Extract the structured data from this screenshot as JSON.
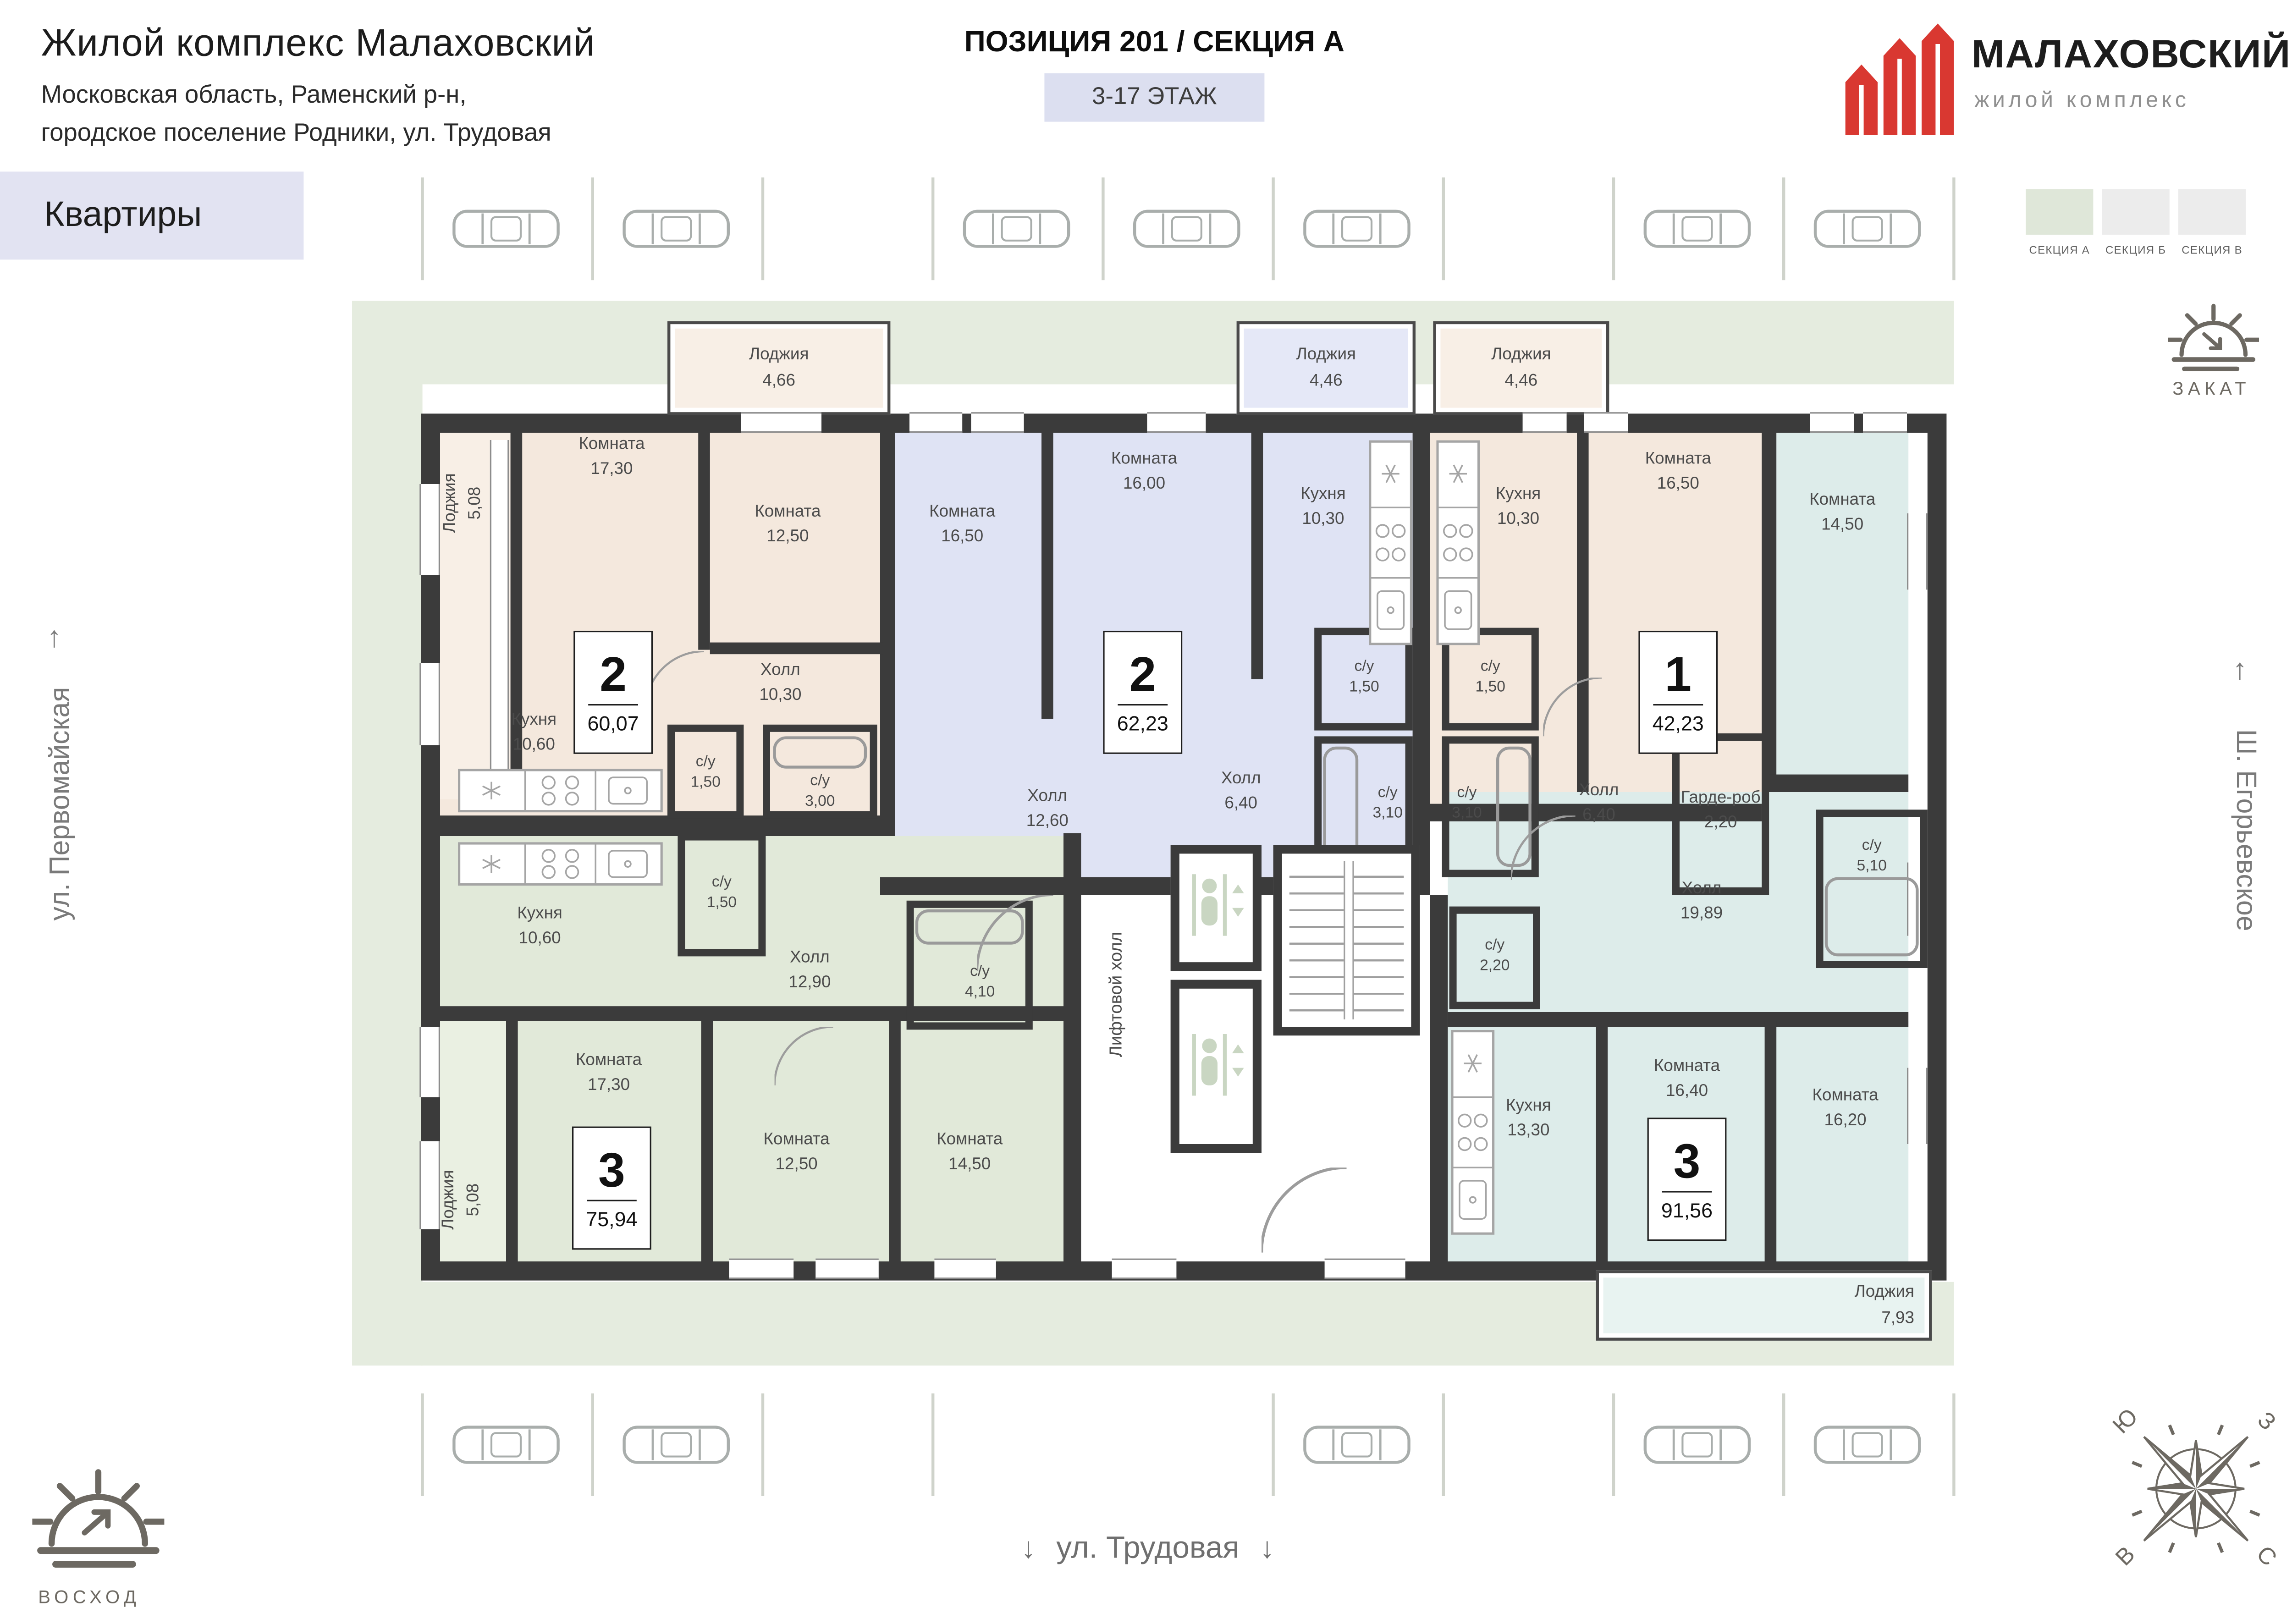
{
  "header": {
    "title": "Жилой комплекс Малаховский",
    "subtitle": [
      "Московская область, Раменский р-н,",
      "городское поселение Родники, ул. Трудовая"
    ],
    "position": "ПОЗИЦИЯ 201 / СЕКЦИЯ А",
    "floors": "3-17 ЭТАЖ",
    "logo": {
      "name": "МАЛАХОВСКИЙ",
      "tagline": "жилой комплекс",
      "brand_color": "#d93831"
    }
  },
  "page_tab": "Квартиры",
  "legend": [
    {
      "label": "СЕКЦИЯ А",
      "color": "#dfe7d9",
      "active": true
    },
    {
      "label": "СЕКЦИЯ Б",
      "color": "#ececec",
      "active": false
    },
    {
      "label": "СЕКЦИЯ В",
      "color": "#ececec",
      "active": false
    }
  ],
  "streets": {
    "left": "ул. Первомайская",
    "right": "Ш. Егорьевское",
    "bottom": "ул. Трудовая",
    "up_arrow": "↑",
    "down_arrow": "↓"
  },
  "sun": {
    "sunrise": "ВОСХОД",
    "sunset": "ЗАКАТ"
  },
  "compass": {
    "s": "Ю",
    "w": "З",
    "e": "В",
    "n": "С"
  },
  "core": {
    "elevator_hall": "Лифтовой холл"
  },
  "apartments": [
    {
      "id": "A",
      "type": "2",
      "total": "60,07",
      "color": "#f4e8dd",
      "rooms": {
        "room1": {
          "label": "Комната",
          "area": "17,30"
        },
        "room2": {
          "label": "Комната",
          "area": "12,50"
        },
        "hall": {
          "label": "Холл",
          "area": "10,30"
        },
        "kitchen": {
          "label": "Кухня",
          "area": "10,60"
        },
        "wc1": {
          "label": "с/у",
          "area": "1,50"
        },
        "wc2": {
          "label": "с/у",
          "area": "3,00"
        },
        "loggia1": {
          "label": "Лоджия",
          "area": "5,08"
        },
        "loggia2": {
          "label": "Лоджия",
          "area": "4,66"
        }
      }
    },
    {
      "id": "B",
      "type": "2",
      "total": "62,23",
      "color": "#dfe3f4",
      "rooms": {
        "room1": {
          "label": "Комната",
          "area": "16,50"
        },
        "room2": {
          "label": "Комната",
          "area": "16,00"
        },
        "kitchen": {
          "label": "Кухня",
          "area": "10,30"
        },
        "hall1": {
          "label": "Холл",
          "area": "12,60"
        },
        "hall2": {
          "label": "Холл",
          "area": "6,40"
        },
        "wc1": {
          "label": "с/у",
          "area": "1,50"
        },
        "wc2": {
          "label": "с/у",
          "area": "3,10"
        },
        "loggia": {
          "label": "Лоджия",
          "area": "4,46"
        }
      }
    },
    {
      "id": "C",
      "type": "1",
      "total": "42,23",
      "color": "#f4e8dd",
      "rooms": {
        "kitchen": {
          "label": "Кухня",
          "area": "10,30"
        },
        "room1": {
          "label": "Комната",
          "area": "16,50"
        },
        "wc1": {
          "label": "с/у",
          "area": "1,50"
        },
        "wc2": {
          "label": "с/у",
          "area": "3,10"
        },
        "hall": {
          "label": "Холл",
          "area": "6,40"
        },
        "wardrobe": {
          "label": "Гарде-роб",
          "area": "2,20"
        },
        "loggia": {
          "label": "Лоджия",
          "area": "4,46"
        }
      }
    },
    {
      "id": "D",
      "type": "3",
      "total": "75,94",
      "color": "#e1e9d9",
      "rooms": {
        "kitchen": {
          "label": "Кухня",
          "area": "10,60"
        },
        "wc1": {
          "label": "с/у",
          "area": "1,50"
        },
        "hall": {
          "label": "Холл",
          "area": "12,90"
        },
        "wc2": {
          "label": "с/у",
          "area": "4,10"
        },
        "room1": {
          "label": "Комната",
          "area": "17,30"
        },
        "room2": {
          "label": "Комната",
          "area": "12,50"
        },
        "room3": {
          "label": "Комната",
          "area": "14,50"
        },
        "loggia": {
          "label": "Лоджия",
          "area": "5,08"
        }
      }
    },
    {
      "id": "E",
      "type": "3",
      "total": "91,56",
      "color": "#ddecea",
      "rooms": {
        "room1": {
          "label": "Комната",
          "area": "14,50"
        },
        "hall": {
          "label": "Холл",
          "area": "19,89"
        },
        "wc1": {
          "label": "с/у",
          "area": "5,10"
        },
        "wc2": {
          "label": "с/у",
          "area": "2,20"
        },
        "kitchen": {
          "label": "Кухня",
          "area": "13,30"
        },
        "room2": {
          "label": "Комната",
          "area": "16,40"
        },
        "room3": {
          "label": "Комната",
          "area": "16,20"
        },
        "loggia": {
          "label": "Лоджия",
          "area": "7,93"
        }
      }
    }
  ]
}
